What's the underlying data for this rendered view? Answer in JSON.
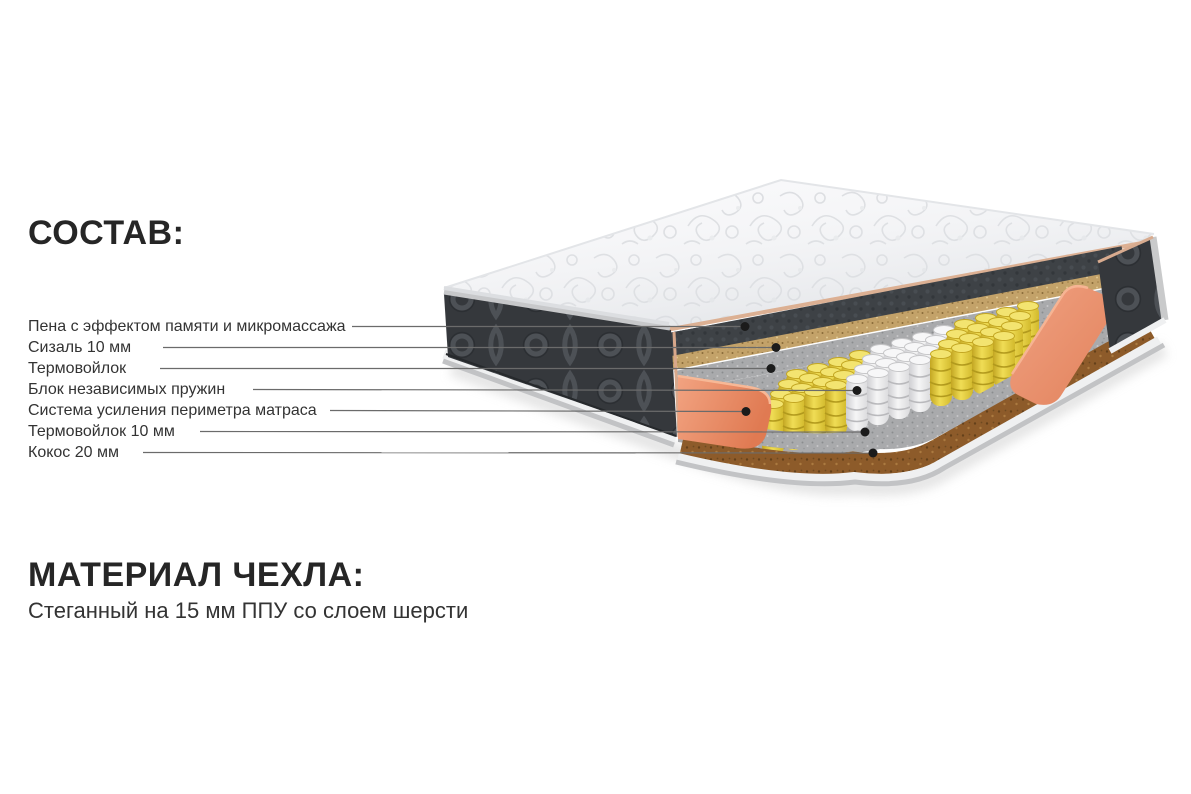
{
  "composition": {
    "title": "СОСТАВ:",
    "items": [
      {
        "label": "Пена с эффектом памяти и микромассажа"
      },
      {
        "label": "Сизаль 10 мм"
      },
      {
        "label": "Термовойлок"
      },
      {
        "label": "Блок независимых пружин"
      },
      {
        "label": "Система усиления периметра матраса"
      },
      {
        "label": "Термовойлок 10 мм"
      },
      {
        "label": "Кокос 20 мм"
      }
    ]
  },
  "cover": {
    "title": "МАТЕРИАЛ ЧЕХЛА:",
    "description": "Стеганный на 15 мм ППУ со слоем шерсти"
  },
  "colors": {
    "bg": "#ffffff",
    "text-title": "#262626",
    "text-label": "#333333",
    "leader-line": "#6b6b6b",
    "leader-dot": "#1b1b1b",
    "quilt": "#f8f8fa",
    "quilt-pattern": "#d6d8dc",
    "panel-black": "#35383c",
    "panel-stitch": "#4d5156",
    "foam-black": "#3e4246",
    "sisal-tan": "#c3a269",
    "felt-gray": "#a9aaac",
    "coconut-brown": "#8d5b2a",
    "spring-yellow": "#e8d23c",
    "spring-white": "#ededee",
    "perimeter-orange": "#e98f6d",
    "binding-gray": "#c2c3c5",
    "piping-white": "#eff0f1",
    "trim-tan": "#dcb093"
  }
}
